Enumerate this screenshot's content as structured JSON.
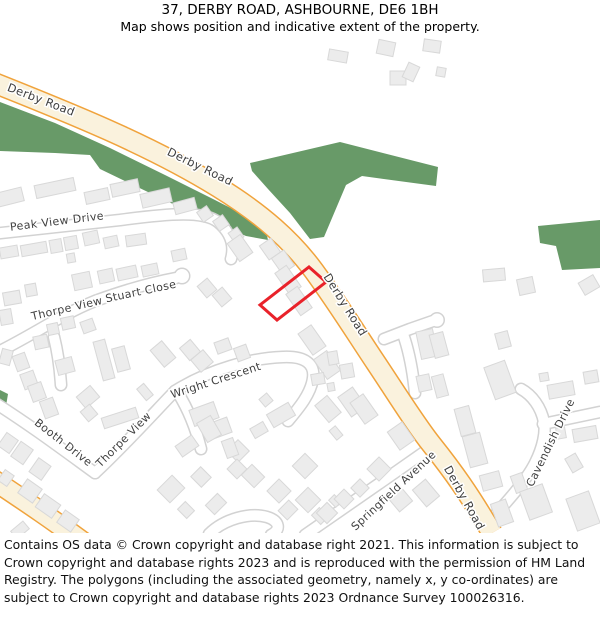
{
  "header": {
    "title": "37, DERBY ROAD, ASHBOURNE, DE6 1BH",
    "subtitle": "Map shows position and indicative extent of the property."
  },
  "footer": {
    "text": "Contains OS data © Crown copyright and database right 2021. This information is subject to Crown copyright and database rights 2023 and is reproduced with the permission of HM Land Registry. The polygons (including the associated geometry, namely x, y co-ordinates) are subject to Crown copyright and database rights 2023 Ordnance Survey 100026316."
  },
  "map": {
    "colors": {
      "green": "#689a68",
      "building_fill": "#ececec",
      "building_stroke": "#d8d8d8",
      "road_main_fill": "#faf2dd",
      "road_main_casing": "#f0a33c",
      "road_minor_fill": "#ffffff",
      "road_minor_casing": "#d2d2d2",
      "label_color": "#3f3f3f",
      "property_outline": "#e9222a"
    },
    "property": {
      "points": "309,234 326,249 277,287 260,272"
    },
    "greens": [
      "M0,69 L55,90 110,115 165,142 215,167 250,185 266,198 268,207 246,203 200,184 150,160 100,136 90,122 55,120 0,118 Z",
      "M250,130 L340,109 438,134 436,153 362,143 346,152 324,204 310,206 290,180 268,156 252,138 Z",
      "M538,193 L600,187 600,235 562,237 556,213 540,210 Z",
      "M0,357 L8,361 6,373 0,375 Z"
    ],
    "major_roads": [
      "M-8,49 C70,80 150,112 218,154 C262,181 292,208 314,238 C338,271 356,300 376,330 C398,363 416,392 432,412 C452,437 470,462 492,500",
      "M-8,446 C25,468 55,488 95,518"
    ],
    "minor_roads": [
      "M-8,201 L120,187 C172,180 204,178 218,189 C230,199 235,212 231,226",
      "M-8,322 C30,304 60,282 95,268 C125,257 155,249 176,245",
      "M54,304 C58,320 60,336 61,352",
      "M-8,368 C30,392 62,416 95,440",
      "M95,440 C122,415 152,382 175,358",
      "M175,358 C210,336 252,325 283,324 C305,323 315,331 313,345 C311,361 298,376 288,388",
      "M178,360 C188,376 196,396 201,416",
      "M305,502 C340,478 390,443 430,415",
      "M209,501 C224,486 250,479 267,484 C280,488 281,497 271,502",
      "M486,492 C506,470 526,448 535,430 C543,414 546,399 544,389 C541,374 532,362 521,356",
      "M543,391 L600,379",
      "M384,306 L410,296 433,288",
      "M403,301 C409,318 413,340 415,360"
    ],
    "bulbs": [
      [
        182,
        243,
        7
      ],
      [
        437,
        287,
        6.5
      ]
    ],
    "buildings": [
      [
        338,
        23,
        19,
        11,
        10
      ],
      [
        386,
        15,
        17,
        14,
        12
      ],
      [
        432,
        13,
        17,
        12,
        8
      ],
      [
        398,
        45,
        16,
        14,
        0
      ],
      [
        411,
        39,
        12,
        16,
        25
      ],
      [
        441,
        39,
        9,
        9,
        10
      ],
      [
        494,
        242,
        22,
        12,
        -5
      ],
      [
        526,
        253,
        16,
        16,
        -12
      ],
      [
        589,
        252,
        17,
        14,
        -30
      ],
      [
        10,
        164,
        26,
        14,
        -14
      ],
      [
        55,
        155,
        40,
        13,
        -12
      ],
      [
        97,
        163,
        24,
        12,
        -12
      ],
      [
        125,
        155,
        28,
        13,
        -12
      ],
      [
        156,
        165,
        30,
        14,
        -13
      ],
      [
        185,
        173,
        22,
        12,
        -15
      ],
      [
        205,
        181,
        12,
        12,
        -35
      ],
      [
        221,
        190,
        12,
        12,
        -35
      ],
      [
        236,
        202,
        11,
        12,
        -35
      ],
      [
        9,
        219,
        18,
        11,
        -10
      ],
      [
        34,
        216,
        26,
        11,
        -10
      ],
      [
        56,
        213,
        12,
        13,
        -10
      ],
      [
        71,
        210,
        13,
        13,
        -10
      ],
      [
        91,
        205,
        15,
        13,
        -12
      ],
      [
        111,
        209,
        14,
        11,
        -12
      ],
      [
        136,
        207,
        20,
        11,
        -8
      ],
      [
        71,
        225,
        8,
        9,
        -10
      ],
      [
        12,
        265,
        17,
        13,
        -10
      ],
      [
        31,
        257,
        11,
        12,
        -10
      ],
      [
        82,
        248,
        18,
        16,
        -12
      ],
      [
        106,
        243,
        15,
        13,
        -12
      ],
      [
        127,
        240,
        20,
        12,
        -12
      ],
      [
        150,
        237,
        16,
        11,
        -12
      ],
      [
        179,
        222,
        14,
        11,
        -12
      ],
      [
        207,
        255,
        13,
        15,
        -40
      ],
      [
        222,
        264,
        13,
        15,
        -40
      ],
      [
        240,
        215,
        16,
        22,
        -35
      ],
      [
        270,
        216,
        14,
        17,
        -35
      ],
      [
        283,
        229,
        15,
        19,
        -35
      ],
      [
        288,
        247,
        14,
        26,
        -35
      ],
      [
        299,
        268,
        14,
        26,
        -35
      ],
      [
        312,
        307,
        16,
        26,
        -35
      ],
      [
        327,
        332,
        16,
        24,
        -35
      ],
      [
        6,
        284,
        12,
        15,
        -10
      ],
      [
        6,
        324,
        11,
        15,
        15
      ],
      [
        21,
        329,
        13,
        16,
        -20
      ],
      [
        29,
        347,
        14,
        16,
        -20
      ],
      [
        37,
        359,
        14,
        17,
        -20
      ],
      [
        49,
        375,
        14,
        18,
        -20
      ],
      [
        41,
        309,
        14,
        13,
        -12
      ],
      [
        53,
        296,
        11,
        11,
        -12
      ],
      [
        68,
        290,
        13,
        12,
        -12
      ],
      [
        88,
        293,
        13,
        12,
        -20
      ],
      [
        104,
        327,
        12,
        40,
        -15
      ],
      [
        121,
        326,
        13,
        24,
        -15
      ],
      [
        65,
        333,
        17,
        15,
        -15
      ],
      [
        88,
        364,
        18,
        15,
        -40
      ],
      [
        89,
        380,
        12,
        13,
        -40
      ],
      [
        8,
        410,
        14,
        16,
        35
      ],
      [
        22,
        420,
        15,
        18,
        35
      ],
      [
        40,
        436,
        15,
        17,
        35
      ],
      [
        6,
        445,
        11,
        13,
        35
      ],
      [
        30,
        458,
        18,
        17,
        35
      ],
      [
        48,
        473,
        20,
        16,
        35
      ],
      [
        68,
        488,
        17,
        15,
        35
      ],
      [
        20,
        497,
        16,
        10,
        -40
      ],
      [
        120,
        385,
        36,
        11,
        -18
      ],
      [
        145,
        359,
        9,
        15,
        -40
      ],
      [
        163,
        321,
        15,
        22,
        -40
      ],
      [
        190,
        317,
        14,
        16,
        -40
      ],
      [
        202,
        328,
        16,
        16,
        -40
      ],
      [
        223,
        313,
        15,
        12,
        -20
      ],
      [
        242,
        320,
        13,
        14,
        -20
      ],
      [
        204,
        381,
        26,
        17,
        -20
      ],
      [
        220,
        395,
        20,
        16,
        -20
      ],
      [
        238,
        418,
        16,
        16,
        -45
      ],
      [
        266,
        367,
        10,
        10,
        -40
      ],
      [
        281,
        382,
        25,
        15,
        -30
      ],
      [
        259,
        397,
        15,
        11,
        -30
      ],
      [
        209,
        396,
        16,
        22,
        -30
      ],
      [
        187,
        413,
        20,
        13,
        -35
      ],
      [
        230,
        415,
        12,
        18,
        -20
      ],
      [
        237,
        436,
        14,
        14,
        -45
      ],
      [
        253,
        443,
        15,
        18,
        -45
      ],
      [
        201,
        444,
        14,
        15,
        -45
      ],
      [
        171,
        456,
        21,
        18,
        -45
      ],
      [
        186,
        477,
        11,
        13,
        -45
      ],
      [
        216,
        471,
        17,
        13,
        -45
      ],
      [
        279,
        458,
        17,
        17,
        -45
      ],
      [
        288,
        477,
        15,
        13,
        -45
      ],
      [
        305,
        433,
        18,
        18,
        -45
      ],
      [
        308,
        467,
        18,
        18,
        -45
      ],
      [
        320,
        483,
        11,
        13,
        -45
      ],
      [
        335,
        468,
        8,
        10,
        -45
      ],
      [
        328,
        376,
        16,
        22,
        -40
      ],
      [
        336,
        400,
        8,
        12,
        -40
      ],
      [
        333,
        325,
        10,
        13,
        -10
      ],
      [
        347,
        338,
        13,
        14,
        -10
      ],
      [
        318,
        346,
        13,
        11,
        -10
      ],
      [
        331,
        354,
        7,
        8,
        -10
      ],
      [
        352,
        369,
        18,
        24,
        -35
      ],
      [
        364,
        376,
        16,
        26,
        -35
      ],
      [
        427,
        311,
        17,
        28,
        -12
      ],
      [
        424,
        350,
        13,
        16,
        -12
      ],
      [
        401,
        403,
        18,
        22,
        -35
      ],
      [
        379,
        436,
        17,
        17,
        -45
      ],
      [
        360,
        455,
        13,
        13,
        -45
      ],
      [
        344,
        466,
        14,
        14,
        -45
      ],
      [
        327,
        480,
        15,
        15,
        -45
      ],
      [
        399,
        465,
        17,
        22,
        -40
      ],
      [
        426,
        460,
        17,
        22,
        -40
      ],
      [
        439,
        312,
        14,
        24,
        -15
      ],
      [
        503,
        307,
        13,
        16,
        -15
      ],
      [
        500,
        347,
        22,
        34,
        -20
      ],
      [
        561,
        357,
        26,
        14,
        -10
      ],
      [
        591,
        344,
        14,
        12,
        -10
      ],
      [
        544,
        344,
        9,
        8,
        -10
      ],
      [
        561,
        400,
        9,
        11,
        -10
      ],
      [
        585,
        401,
        24,
        13,
        -10
      ],
      [
        574,
        430,
        12,
        16,
        -30
      ],
      [
        440,
        353,
        12,
        22,
        -15
      ],
      [
        465,
        388,
        15,
        28,
        -15
      ],
      [
        475,
        417,
        18,
        32,
        -15
      ],
      [
        491,
        448,
        20,
        16,
        -15
      ],
      [
        519,
        450,
        12,
        18,
        -20
      ],
      [
        536,
        469,
        24,
        30,
        -20
      ],
      [
        583,
        478,
        24,
        34,
        -20
      ],
      [
        502,
        480,
        16,
        24,
        -20
      ]
    ],
    "labels": [
      {
        "text": "Derby Road",
        "x": 41,
        "y": 67,
        "angle": 21,
        "size": 11.5
      },
      {
        "text": "Derby Road",
        "x": 200,
        "y": 134,
        "angle": 26,
        "size": 11.5
      },
      {
        "text": "Derby Road",
        "x": 345,
        "y": 272,
        "angle": 58,
        "size": 11.5
      },
      {
        "text": "Derby Road",
        "x": 464,
        "y": 465,
        "angle": 61,
        "size": 11.5
      },
      {
        "text": "Peak View Drive",
        "x": 57,
        "y": 189,
        "angle": -7,
        "size": 11
      },
      {
        "text": "Stuart Close",
        "x": 141,
        "y": 259,
        "angle": -12,
        "size": 11
      },
      {
        "text": "Thorpe View",
        "x": 67,
        "y": 276,
        "angle": -13,
        "size": 11
      },
      {
        "text": "Booth Drive",
        "x": 63,
        "y": 410,
        "angle": 38,
        "size": 11
      },
      {
        "text": "Thorpe View",
        "x": 124,
        "y": 407,
        "angle": -45,
        "size": 11
      },
      {
        "text": "Wright Crescent",
        "x": 216,
        "y": 348,
        "angle": -18,
        "size": 11
      },
      {
        "text": "Springfield Avenue",
        "x": 394,
        "y": 458,
        "angle": -43,
        "size": 11
      },
      {
        "text": "Cavendish Drive",
        "x": 551,
        "y": 410,
        "angle": -64,
        "size": 11
      }
    ]
  }
}
